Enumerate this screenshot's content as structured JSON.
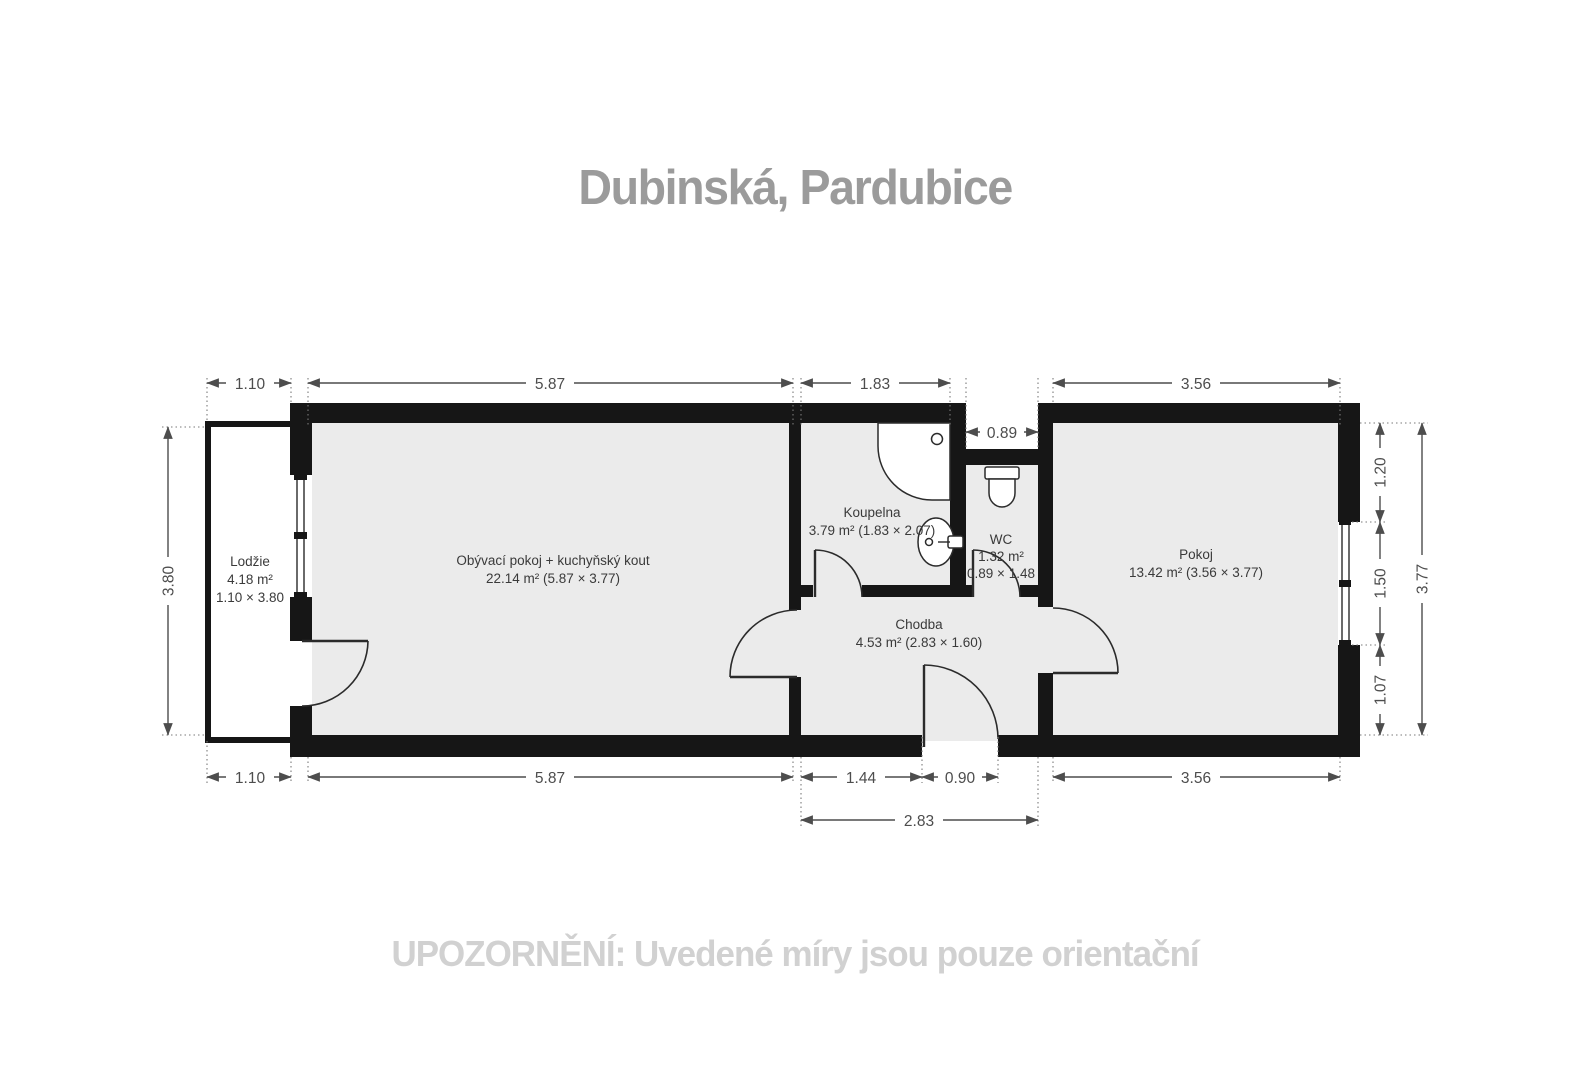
{
  "title": "Dubinská, Pardubice",
  "disclaimer": "UPOZORNĚNÍ: Uvedené míry jsou pouze orientační",
  "colors": {
    "wall": "#161616",
    "floor": "#ebebeb",
    "loggia_floor": "#ffffff",
    "dimension": "#4d4d4d",
    "title_text": "#9b9b9b",
    "disclaimer_text": "#d1d1d1"
  },
  "rooms": {
    "lodzie": {
      "name": "Lodžie",
      "area": "4.18 m²",
      "size": "1.10 × 3.80"
    },
    "obyvaci": {
      "name": "Obývací pokoj + kuchyňský kout",
      "area": "22.14 m² (5.87 × 3.77)"
    },
    "koupelna": {
      "name": "Koupelna",
      "area": "3.79 m² (1.83 × 2.07)"
    },
    "wc": {
      "name": "WC",
      "area": "1.32 m²",
      "size": "0.89 × 1.48"
    },
    "chodba": {
      "name": "Chodba",
      "area": "4.53 m² (2.83 × 1.60)"
    },
    "pokoj": {
      "name": "Pokoj",
      "area": "13.42 m² (3.56 × 3.77)"
    }
  },
  "dimensions": {
    "lodzie_width": "1.10",
    "living_width": "5.87",
    "bathroom_width": "1.83",
    "wc_width": "0.89",
    "room_width": "3.56",
    "lodzie_height": "3.80",
    "right_above_window": "1.20",
    "right_window": "1.50",
    "right_below_window": "1.07",
    "right_total": "3.77",
    "hall_to_door": "1.44",
    "entry_door": "0.90",
    "hall_total": "2.83"
  }
}
